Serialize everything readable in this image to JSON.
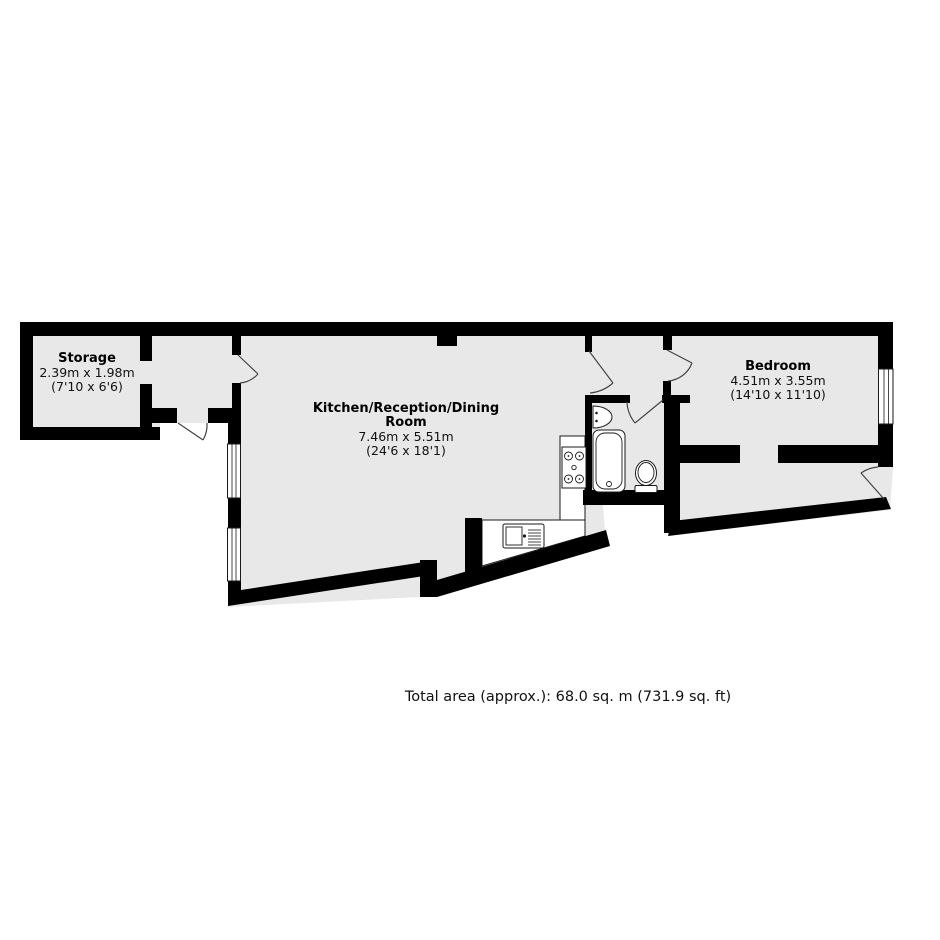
{
  "meta": {
    "kind": "estate-agent-floorplan"
  },
  "colors": {
    "background": "#ffffff",
    "floor": "#e8e8e8",
    "wall": "#000000",
    "fixture_outline": "#1a1a1a"
  },
  "rooms": {
    "storage": {
      "name": "Storage",
      "metric": "2.39m x 1.98m",
      "imperial": "(7'10 x 6'6)"
    },
    "kitchen": {
      "name_line1": "Kitchen/Reception/Dining",
      "name_line2": "Room",
      "metric": "7.46m x 5.51m",
      "imperial": "(24'6 x 18'1)"
    },
    "bedroom": {
      "name": "Bedroom",
      "metric": "4.51m x 3.55m",
      "imperial": "(14'10 x 11'10)"
    }
  },
  "fixtures": [
    "bathtub",
    "toilet",
    "wash-basin",
    "hob",
    "kitchen-sink",
    "worktop"
  ],
  "openings": [
    "entrance-door",
    "storage-door",
    "kitchen-door",
    "inner-hall-door",
    "bathroom-door",
    "bedroom-door",
    "rear-door",
    "window-kitchen-1",
    "window-kitchen-2",
    "window-bedroom"
  ],
  "footer": {
    "total_area": "Total area (approx.): 68.0 sq. m (731.9 sq. ft)"
  }
}
